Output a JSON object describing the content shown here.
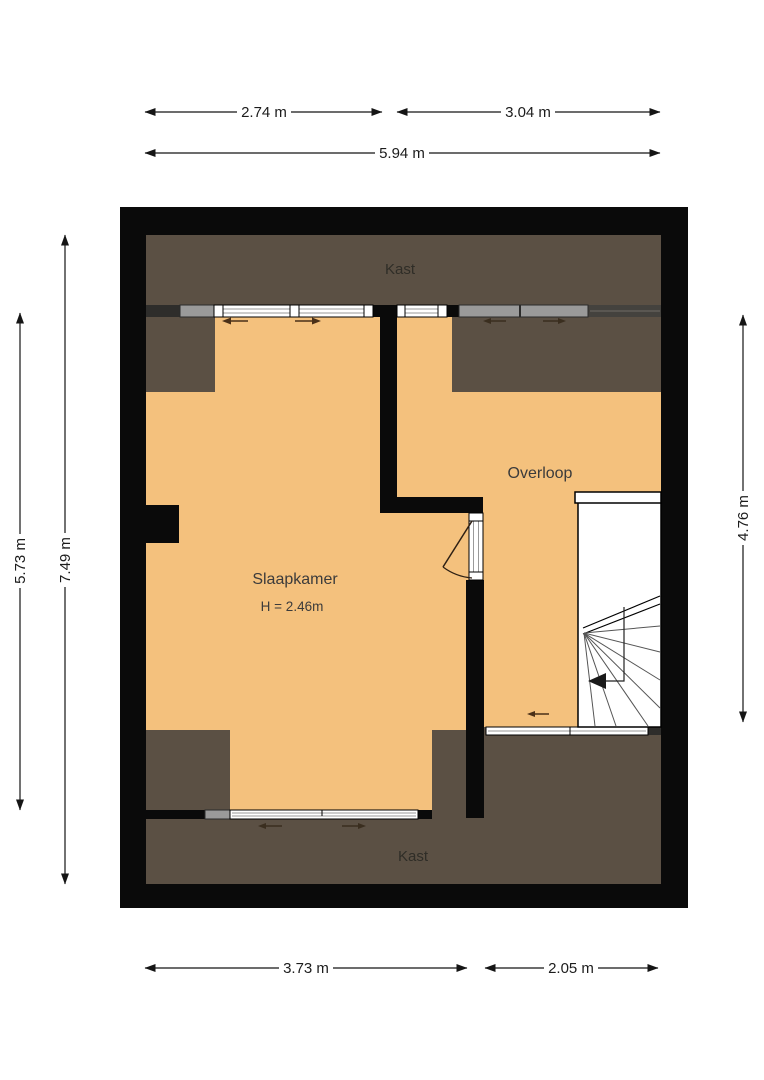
{
  "rooms": {
    "kast_top": "Kast",
    "kast_bottom": "Kast",
    "slaapkamer": "Slaapkamer",
    "slaapkamer_height": "H = 2.46m",
    "overloop": "Overloop"
  },
  "dims": {
    "top_left": "2.74 m",
    "top_right": "3.04 m",
    "top_total": "5.94 m",
    "left_inner": "5.73 m",
    "left_outer": "7.49 m",
    "right": "4.76 m",
    "bottom_left": "3.73 m",
    "bottom_right": "2.05 m"
  },
  "icons": {
    "slide_left": "sliding-window-arrow-left",
    "slide_right": "sliding-window-arrow-right",
    "stair_direction": "stair-direction-arrow-down"
  },
  "colors": {
    "floor": "#f4c17d",
    "low_ceiling": "#5b5044",
    "wall": "#0a0a0a",
    "window": "#ffffff",
    "background": "#ffffff"
  }
}
